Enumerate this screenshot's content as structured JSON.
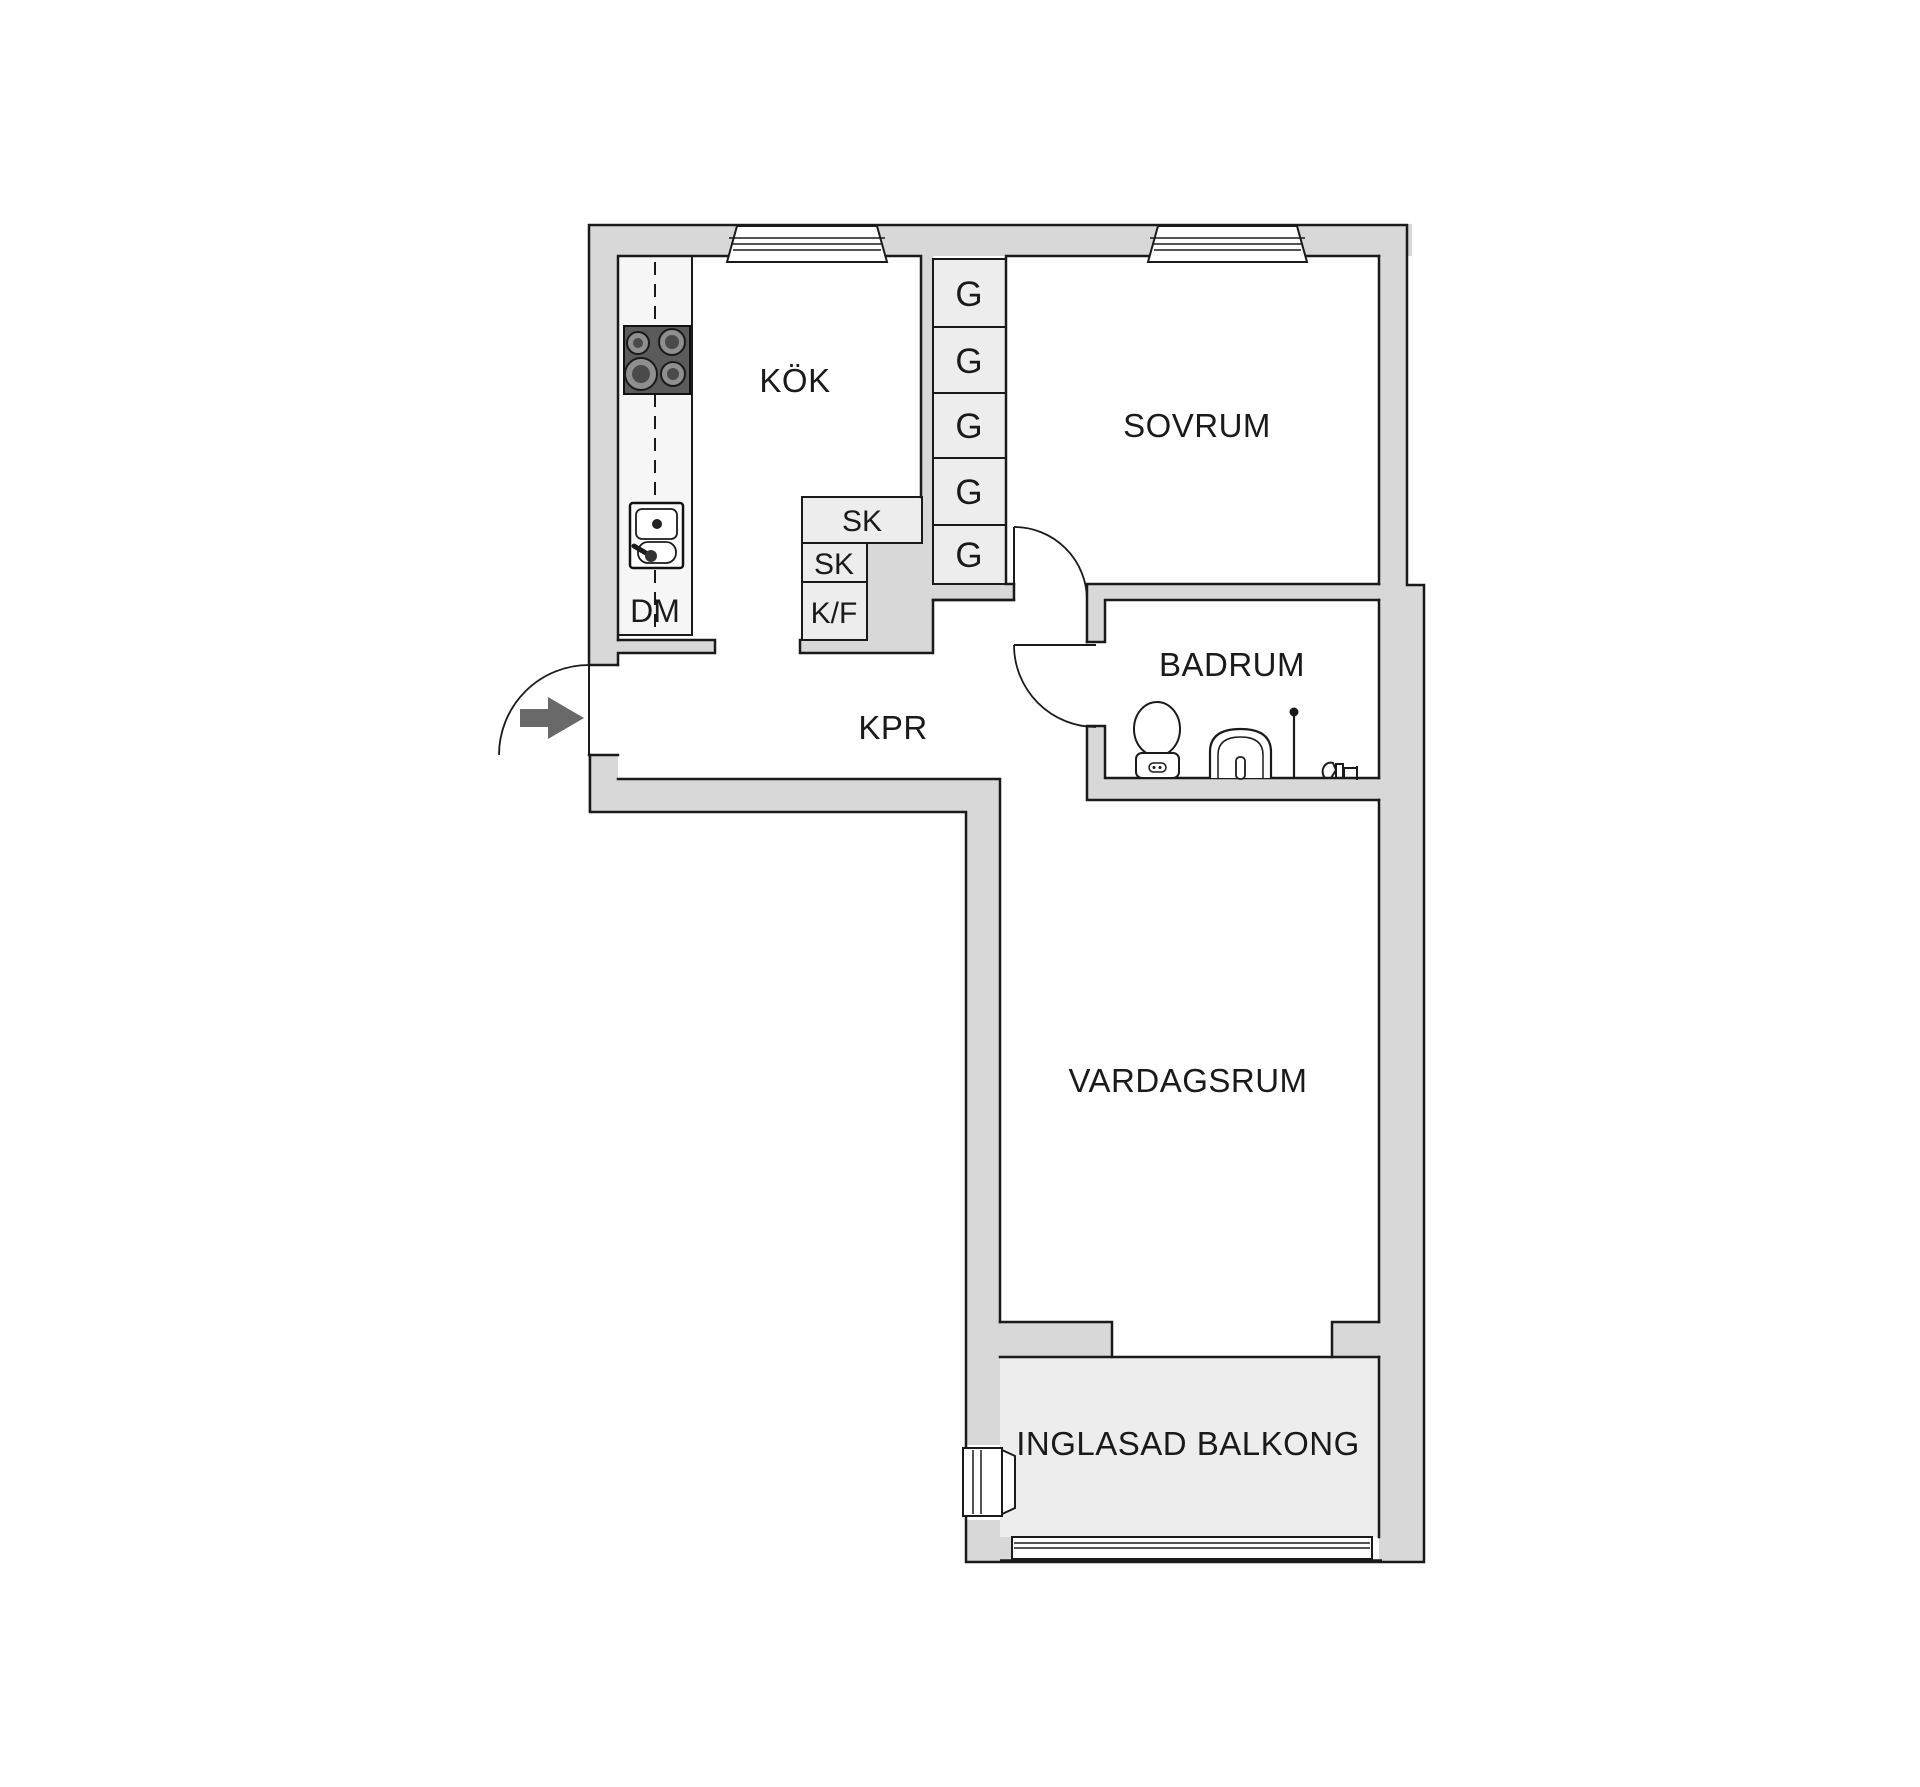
{
  "title": "apartment-floor-plan",
  "colors": {
    "wall": "#d8d8d8",
    "unit_fill": "#ededed",
    "counter_fill": "#f6f6f6",
    "line": "#1a1a1a",
    "stove": "#5b5b5b",
    "entry_arrow": "#696969",
    "background": "#ffffff"
  },
  "rooms": {
    "kok": "KÖK",
    "sovrum": "SOVRUM",
    "badrum": "BADRUM",
    "kpr": "KPR",
    "vardagsrum": "VARDAGSRUM",
    "balkong": "INGLASAD BALKONG"
  },
  "units": {
    "dm": "DM",
    "sk_upper": "SK",
    "sk_lower": "SK",
    "kf": "K/F",
    "g": [
      "G",
      "G",
      "G",
      "G",
      "G"
    ]
  }
}
